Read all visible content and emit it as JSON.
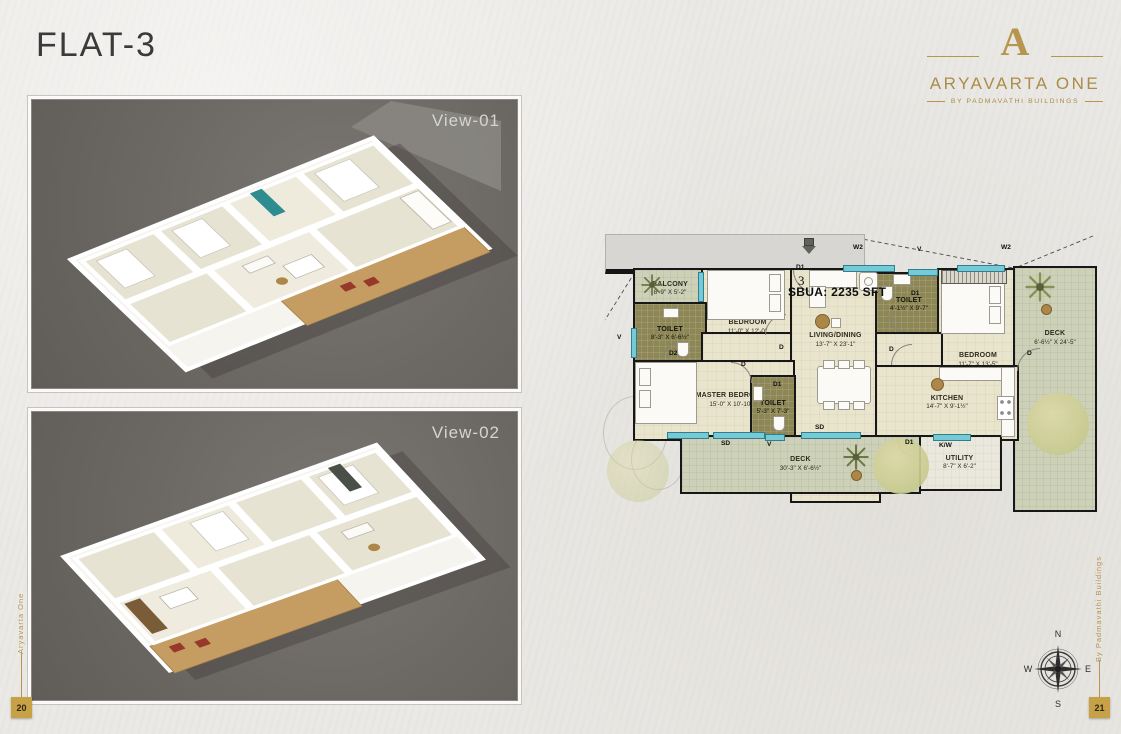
{
  "page": {
    "title": "FLAT-3",
    "left_page": "20",
    "right_page": "21",
    "left_side_text": "Aryavarta One",
    "right_side_text": "By Padmavathi Buildings"
  },
  "brand": {
    "monogram": "A",
    "name": "ARYAVARTA ONE",
    "tagline": "BY PADMAVATHI BUILDINGS",
    "gold": "#b6954e"
  },
  "views": [
    {
      "label": "View-01"
    },
    {
      "label": "View-02"
    }
  ],
  "floorplan": {
    "flat_number": "3",
    "area_label": "SBUA: 2235 SFT",
    "rooms": [
      {
        "name": "BALCONY",
        "dims": "8'-9\" X 5'-2\""
      },
      {
        "name": "BEDROOM",
        "dims": "11'-0\" X 12'-0\""
      },
      {
        "name": "TOILET",
        "dims": "8'-3\" X 6'-6½\""
      },
      {
        "name": "LIVING/DINING",
        "dims": "13'-7\" X 23'-1\""
      },
      {
        "name": "TOILET",
        "dims": "4'-1½\" X 9'-7\""
      },
      {
        "name": "BEDROOM",
        "dims": "11'-7\" X 13'-5\""
      },
      {
        "name": "DECK",
        "dims": "6'-6½\" X 24'-5\""
      },
      {
        "name": "MASTER BEDROOM",
        "dims": "15'-0\" X 10'-10\""
      },
      {
        "name": "TOILET",
        "dims": "5'-3\" X 7'-3\""
      },
      {
        "name": "KITCHEN",
        "dims": "14'-7\" X 9'-1½\""
      },
      {
        "name": "UTILITY",
        "dims": "8'-7\" X 6'-2\""
      },
      {
        "name": "DECK",
        "dims": "30'-3\" X 6'-6½\""
      }
    ],
    "markers": {
      "w2": "W2",
      "v": "V",
      "sd": "SD",
      "d": "D",
      "d1": "D1",
      "d2": "D2",
      "kw": "K/W"
    },
    "colors": {
      "wall": "#171717",
      "floor": "#e9e5cd",
      "toilet": "#8d8756",
      "deck": "#cdd1b8",
      "window": "#76cad8"
    }
  },
  "compass": {
    "north": "N",
    "east": "E",
    "south": "S",
    "west": "W"
  }
}
